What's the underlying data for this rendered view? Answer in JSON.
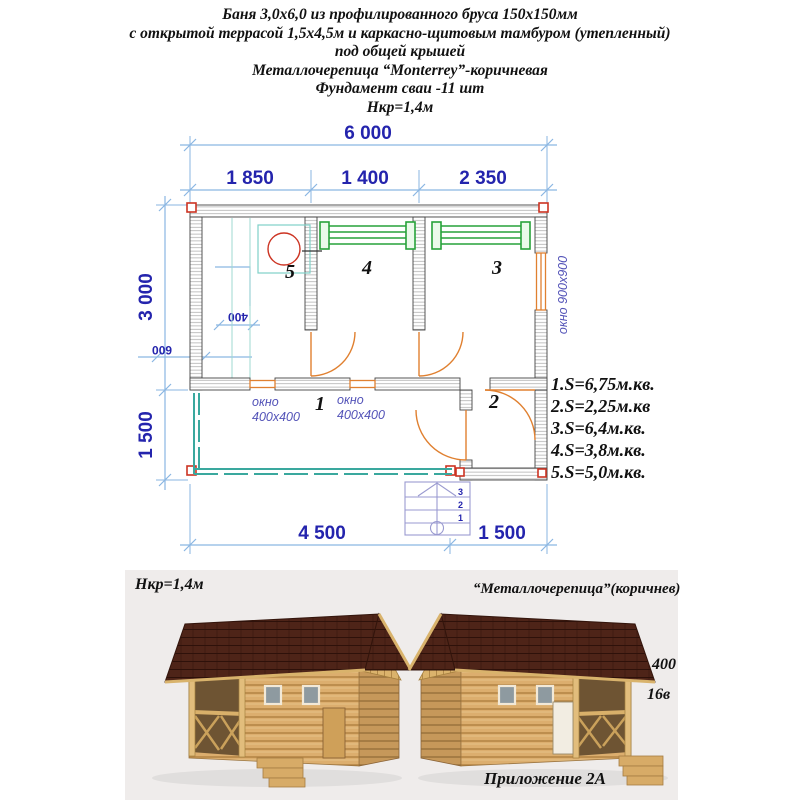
{
  "header": {
    "line1": "Баня 3,0х6,0 из профилированного бруса 150х150мм",
    "line2": "с открытой террасой 1,5х4,5м и каркасно-щитовым тамбуром (утепленный)",
    "line3": "под общей крышей",
    "line4": "Металлочерепица “Monterrey”-коричневая",
    "line5": "Фундамент сваи -11 шт",
    "line6": "Нкр=1,4м"
  },
  "plan": {
    "dims": {
      "total": "6 000",
      "seg1": "1 850",
      "seg2": "1 400",
      "seg3": "2 350",
      "left_main": "3 000",
      "left_terrace": "1 500",
      "bottom_main": "4 500",
      "bottom_tambour": "1 500",
      "stove_400": "400",
      "stove_600": "600"
    },
    "rooms": {
      "r1": "1",
      "r2": "2",
      "r3": "3",
      "r4": "4",
      "r5": "5"
    },
    "labels": {
      "window_right": "окно 900х900",
      "window_word": "окно",
      "window_size": "400х400"
    },
    "stairs": {
      "s1": "1",
      "s2": "2",
      "s3": "3"
    },
    "areas": [
      "1.S=6,75м.кв.",
      "2.S=2,25м.кв",
      "3.S=6,4м.кв.",
      "4.S=3,8м.кв.",
      "5.S=5,0м.кв."
    ]
  },
  "renders": {
    "left_caption": "Нкр=1,4м",
    "right_caption": "“Металлочерепица”(коричнев)",
    "annotation_400": "400",
    "annotation_16v": "16в",
    "footer": "Приложение 2А"
  },
  "colors": {
    "dim_line": "#8ab6e2",
    "dim_text": "#2424ad",
    "bench_green": "#27a23a",
    "door_orange": "#e08030",
    "railing_teal": "#3aa89e",
    "stove_red": "#cc3322",
    "roof_brown": "#4e2418",
    "wood_tan": "#dcae6e",
    "band_bg": "#efeceb"
  }
}
